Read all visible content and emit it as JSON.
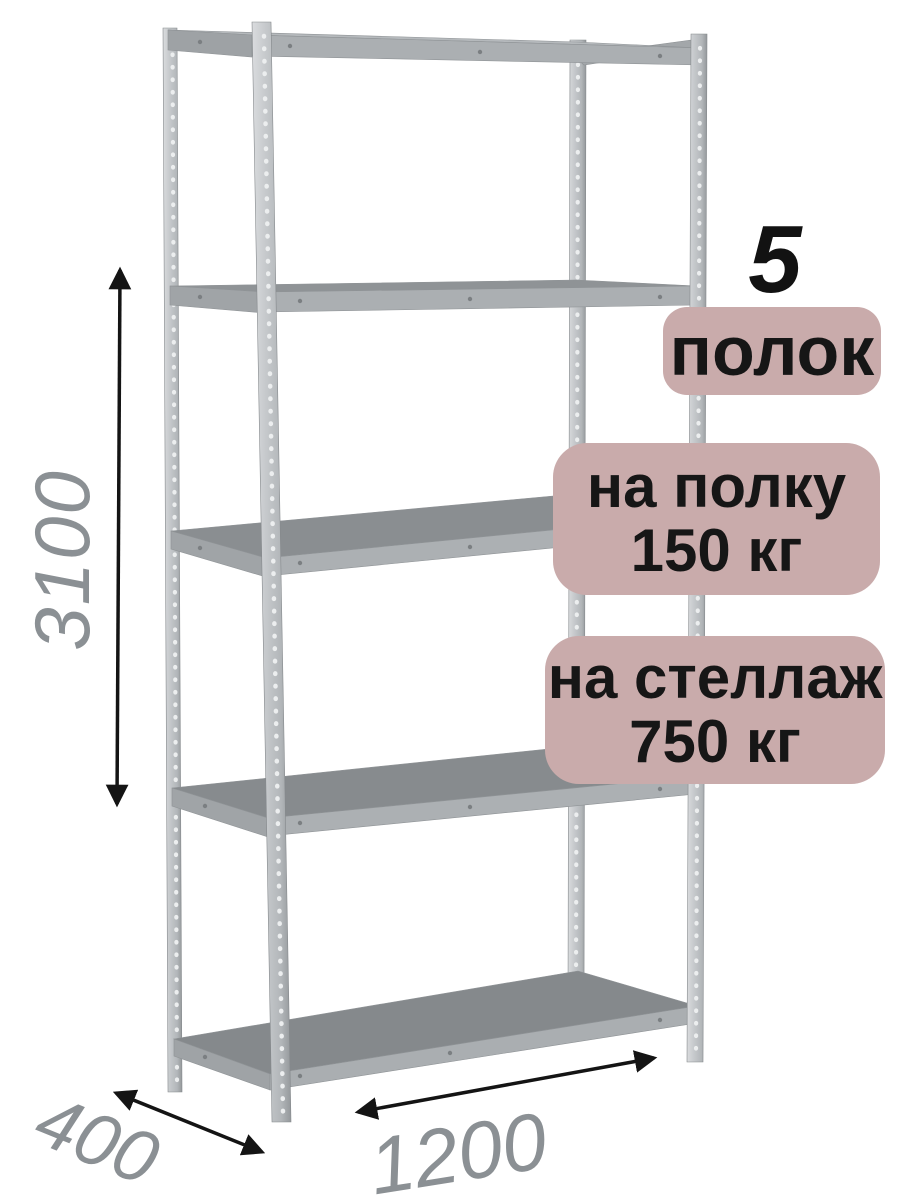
{
  "badges": {
    "count": {
      "number": "5",
      "label": "полок"
    },
    "shelf_load": {
      "line1": "на полку",
      "line2": "150 кг"
    },
    "rack_load": {
      "line1": "на стеллаж",
      "line2": "750 кг"
    }
  },
  "dimensions": {
    "height_mm": "3100",
    "depth_mm": "400",
    "width_mm": "1200"
  },
  "colors": {
    "badge_background": "#c9abab",
    "badge_text": "#161616",
    "dimension_text": "#8b9094",
    "arrow": "#141414",
    "metal_post_light": "#c6c9cc",
    "metal_beam": "#abafb2",
    "shelf_top_dark": "#868a8d",
    "background": "#ffffff"
  },
  "icons": {
    "height_arrow": "double-headed-arrow-vertical",
    "depth_arrow": "double-headed-arrow-diagonal",
    "width_arrow": "double-headed-arrow-diagonal"
  }
}
